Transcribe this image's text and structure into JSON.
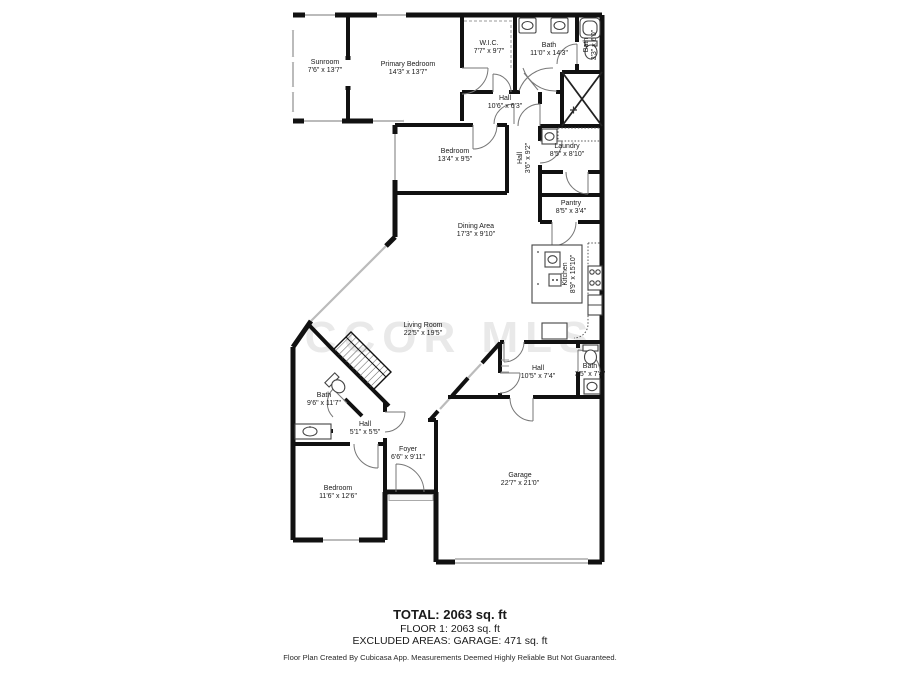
{
  "watermark": "CCOR MLS",
  "rooms": {
    "sunroom": {
      "name": "Sunroom",
      "dims": "7'6\" x 13'7\""
    },
    "primary_bedroom": {
      "name": "Primary Bedroom",
      "dims": "14'3\" x 13'7\""
    },
    "wic": {
      "name": "W.I.C.",
      "dims": "7'7\" x 9'7\""
    },
    "bath_primary": {
      "name": "Bath",
      "dims": "11'0\" x 14'3\""
    },
    "bath_small_top": {
      "name": "Bath",
      "dims": "3'3\" x 6'0\""
    },
    "hall_top": {
      "name": "Hall",
      "dims": "10'6\" x 6'3\""
    },
    "bedroom_middle": {
      "name": "Bedroom",
      "dims": "13'4\" x 9'5\""
    },
    "hall_vertical": {
      "name": "Hall",
      "dims": "3'6\" x 9'2\""
    },
    "laundry": {
      "name": "Laundry",
      "dims": "8'5\" x 8'10\""
    },
    "pantry": {
      "name": "Pantry",
      "dims": "8'5\" x 3'4\""
    },
    "dining_area": {
      "name": "Dining Area",
      "dims": "17'3\" x 9'10\""
    },
    "kitchen": {
      "name": "Kitchen",
      "dims": "8'9\" x 15'10\""
    },
    "living_room": {
      "name": "Living Room",
      "dims": "22'5\" x 19'5\""
    },
    "hall_lower": {
      "name": "Hall",
      "dims": "10'5\" x 7'4\""
    },
    "bath_lower_right": {
      "name": "Bath",
      "dims": "3'5\" x 7'4\""
    },
    "bath_lower_left": {
      "name": "Bath",
      "dims": "9'6\" x 11'7\""
    },
    "hall_small": {
      "name": "Hall",
      "dims": "5'1\" x 5'5\""
    },
    "foyer": {
      "name": "Foyer",
      "dims": "6'6\" x 9'11\""
    },
    "bedroom_lower": {
      "name": "Bedroom",
      "dims": "11'6\" x 12'6\""
    },
    "garage": {
      "name": "Garage",
      "dims": "22'7\" x 21'0\""
    }
  },
  "summary": {
    "total": "TOTAL: 2063 sq. ft",
    "floor1": "FLOOR 1: 2063 sq. ft",
    "excluded": "EXCLUDED AREAS: GARAGE: 471 sq. ft"
  },
  "attribution": "Floor Plan Created By Cubicasa App. Measurements Deemed Highly Reliable But Not Guaranteed.",
  "colors": {
    "wall": "#111111",
    "window": "#bbbbbb",
    "watermark": "#e9e9e9"
  }
}
